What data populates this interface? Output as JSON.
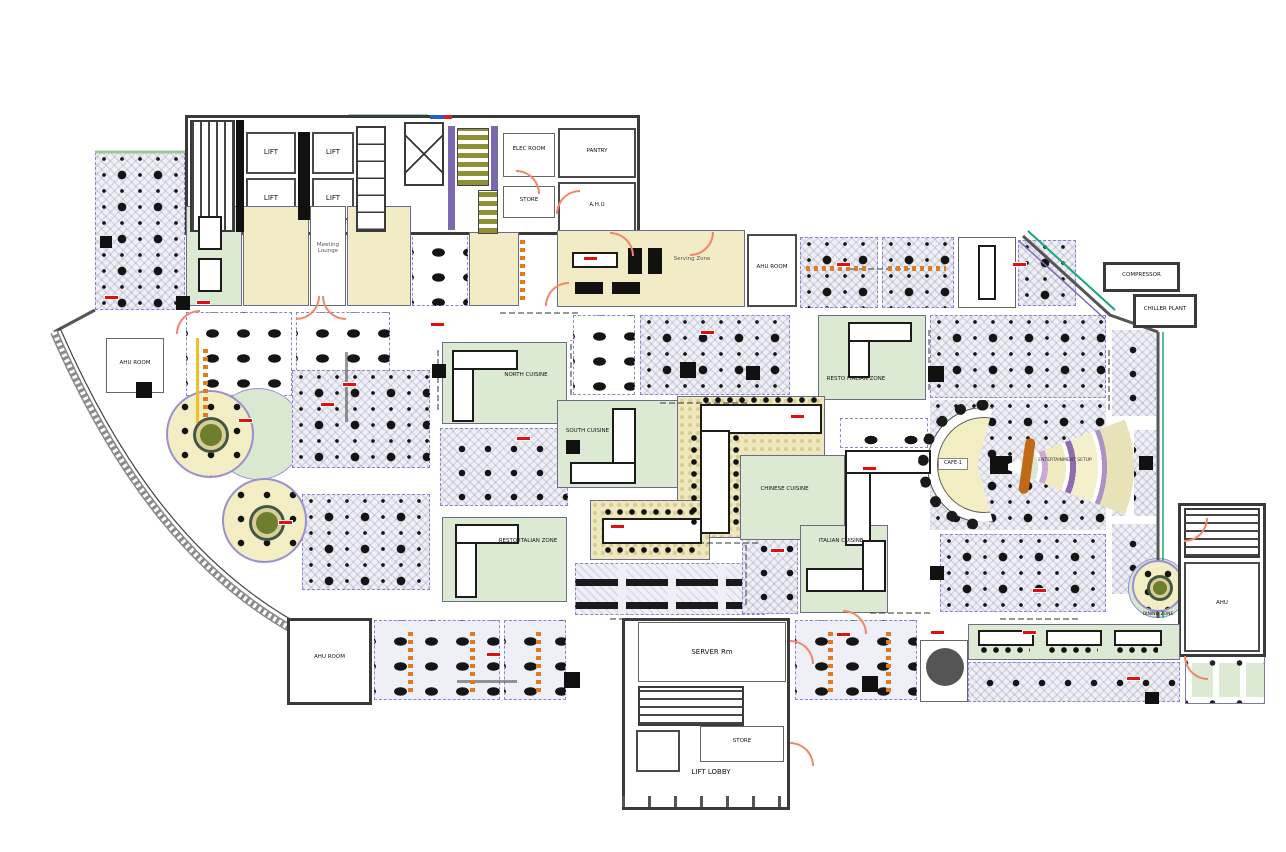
{
  "title": "Food Court Floor Plan",
  "colors": {
    "accent_teal": "#18a57c",
    "accent_purple": "#7b68ae",
    "stair_olive": "#8f8f33",
    "door_orange": "#f0876a",
    "lounge_yellow": "#f1ebc6",
    "counter_green": "#dcead3",
    "tag_red": "#e01010",
    "chair_orange": "#e07b20"
  },
  "rooms": {
    "lift1": "LIFT",
    "lift2": "LIFT",
    "lift3": "LIFT",
    "lift4": "LIFT",
    "elec_room": "ELEC ROOM",
    "pantry": "PANTRY",
    "ahu_top": "A.H.U",
    "store_top": "STORE",
    "meeting_lounge": "Meeting Lounge",
    "serving_zone": "Serving Zone",
    "ahu_room_mid": "AHU ROOM",
    "compressor": "COMPRESSOR",
    "chiller_plant": "CHILLER PLANT",
    "ahu_room_left": "AHU ROOM",
    "ahu_room_bottomleft": "AHU ROOM",
    "server_room": "SERVER Rm",
    "store_bottom": "STORE",
    "lift_lobby": "LIFT LOBBY",
    "ahu_right": "AHU"
  },
  "zones": {
    "north_cuisine": "NORTH CUISINE",
    "south_cuisine": "SOUTH CUISINE",
    "chinese_cuisine": "CHINESE CUISINE",
    "italian_cuisine": "ITALIAN CUISINE",
    "resto_italian_a": "RESTO ITALIAN ZONE",
    "resto_italian_b": "RESTO ITALIAN ZONE",
    "cafe": "CAFE-1",
    "stage": "ENTERTAINMENT SETUP",
    "dining_zone": "DINING ZONE"
  }
}
